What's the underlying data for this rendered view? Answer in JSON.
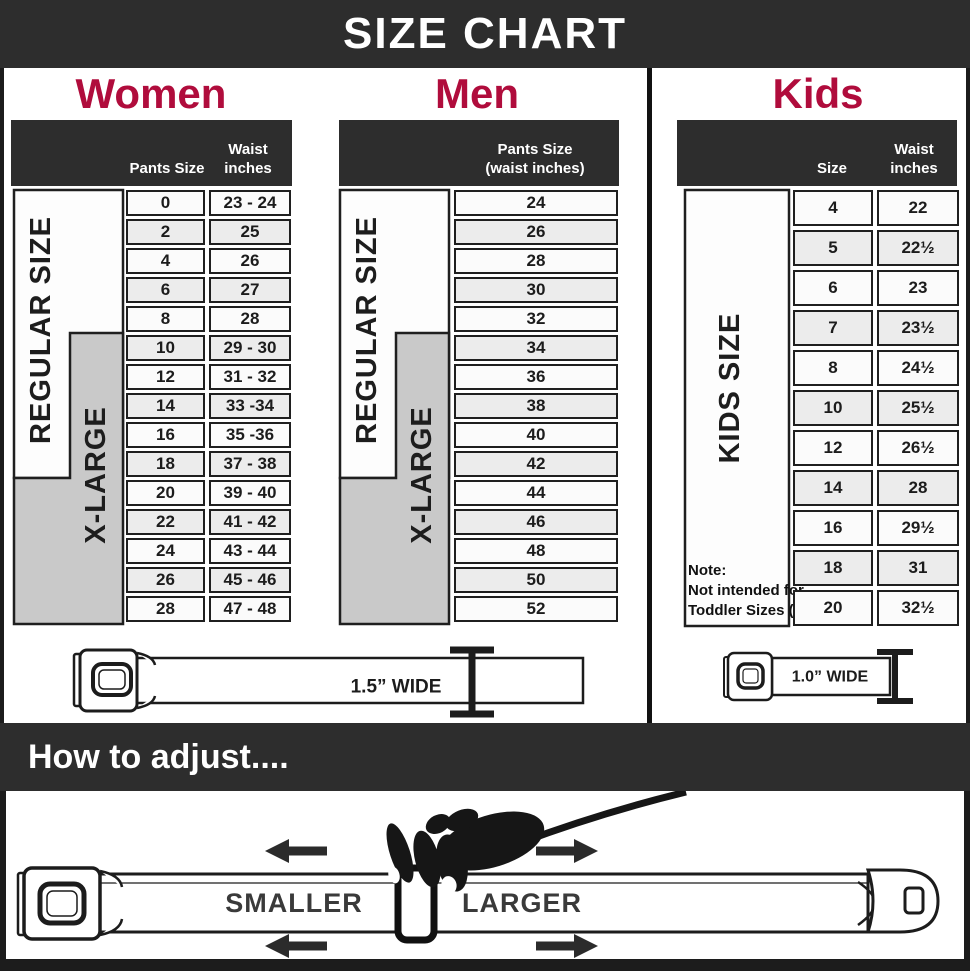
{
  "title": "SIZE CHART",
  "colors": {
    "accent": "#b00c3c",
    "header_bar": "#2d2d2d",
    "xlarge_gray": "#c9c9c9"
  },
  "women": {
    "heading": "Women",
    "header": {
      "col1": "Pants Size",
      "col2_line1": "Waist",
      "col2_line2": "inches"
    },
    "group_labels": {
      "regular": "REGULAR SIZE",
      "xlarge": "X-LARGE"
    },
    "rows": [
      [
        "0",
        "23 - 24"
      ],
      [
        "2",
        "25"
      ],
      [
        "4",
        "26"
      ],
      [
        "6",
        "27"
      ],
      [
        "8",
        "28"
      ],
      [
        "10",
        "29 - 30"
      ],
      [
        "12",
        "31 - 32"
      ],
      [
        "14",
        "33 -34"
      ],
      [
        "16",
        "35 -36"
      ],
      [
        "18",
        "37 - 38"
      ],
      [
        "20",
        "39 - 40"
      ],
      [
        "22",
        "41 - 42"
      ],
      [
        "24",
        "43 - 44"
      ],
      [
        "26",
        "45 - 46"
      ],
      [
        "28",
        "47 - 48"
      ]
    ]
  },
  "men": {
    "heading": "Men",
    "header": {
      "line1": "Pants Size",
      "line2": "(waist inches)"
    },
    "group_labels": {
      "regular": "REGULAR SIZE",
      "xlarge": "X-LARGE"
    },
    "rows": [
      "24",
      "26",
      "28",
      "30",
      "32",
      "34",
      "36",
      "38",
      "40",
      "42",
      "44",
      "46",
      "48",
      "50",
      "52"
    ]
  },
  "kids": {
    "heading": "Kids",
    "header": {
      "col1": "Size",
      "col2_line1": "Waist",
      "col2_line2": "inches"
    },
    "group_label": "KIDS SIZE",
    "note_lines": [
      "Note:",
      "Not intended for",
      "Toddler Sizes (T)"
    ],
    "rows": [
      [
        "4",
        "22"
      ],
      [
        "5",
        "22½"
      ],
      [
        "6",
        "23"
      ],
      [
        "7",
        "23½"
      ],
      [
        "8",
        "24½"
      ],
      [
        "10",
        "25½"
      ],
      [
        "12",
        "26½"
      ],
      [
        "14",
        "28"
      ],
      [
        "16",
        "29½"
      ],
      [
        "18",
        "31"
      ],
      [
        "20",
        "32½"
      ]
    ]
  },
  "belts": {
    "women_men_width": "1.5” WIDE",
    "kids_width": "1.0” WIDE"
  },
  "adjust": {
    "heading": "How to adjust....",
    "smaller": "SMALLER",
    "larger": "LARGER"
  }
}
